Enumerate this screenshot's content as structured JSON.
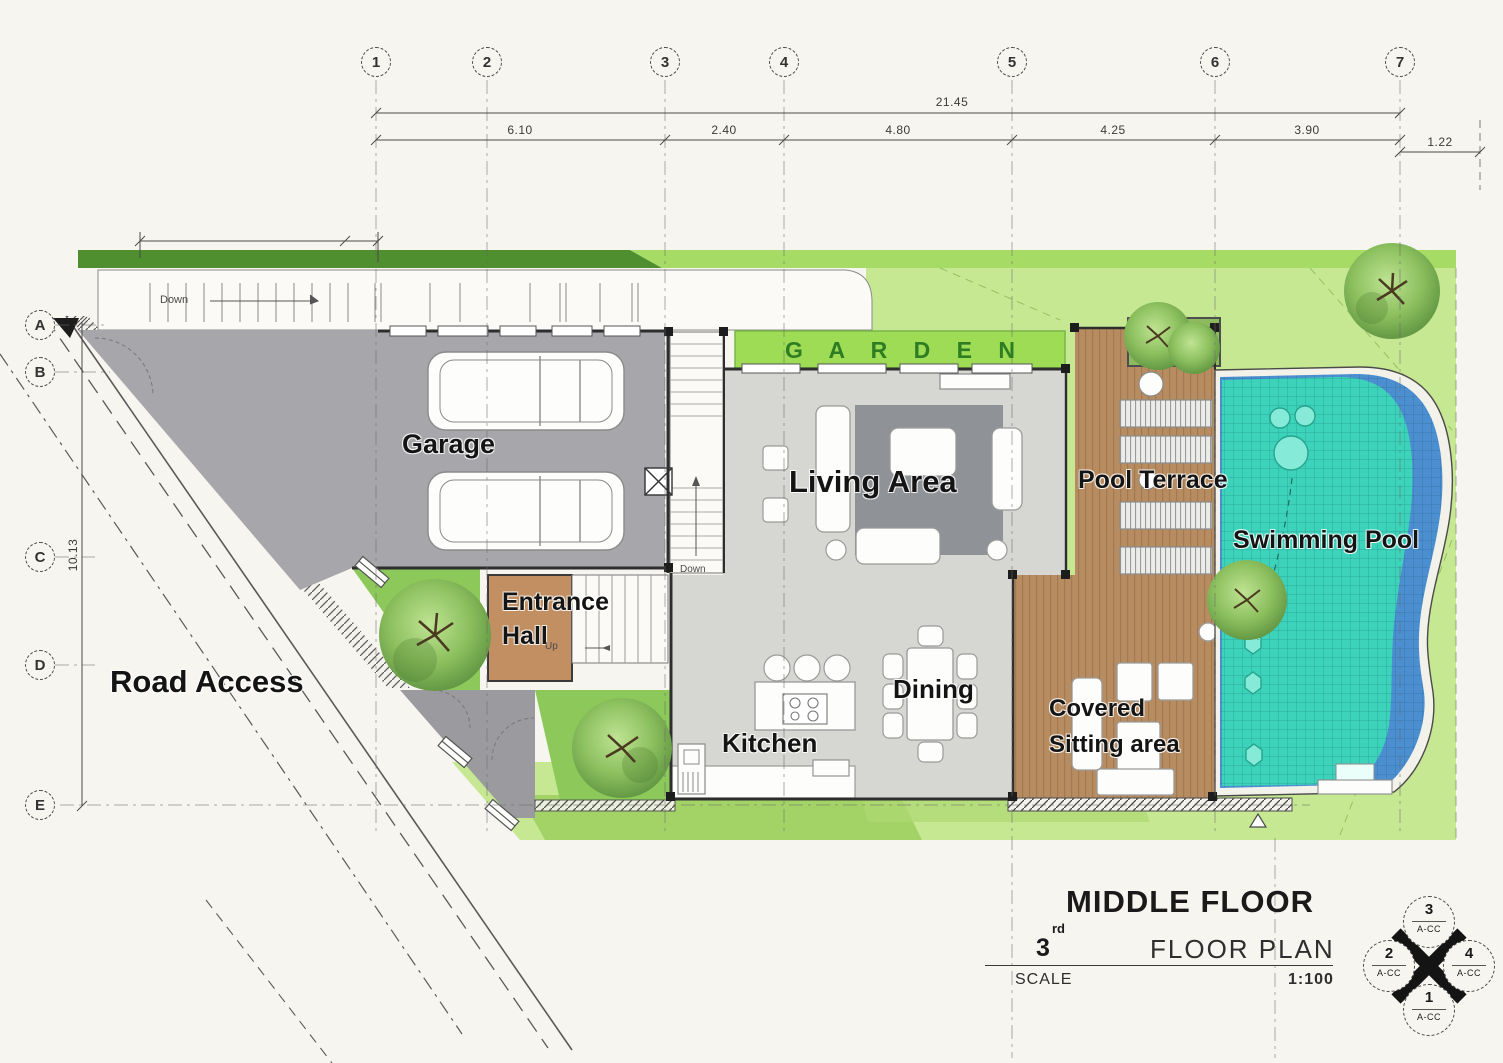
{
  "title_block": {
    "floor_title": "MIDDLE FLOOR",
    "floor_number": "3",
    "floor_ordinal": "rd",
    "plan_type": "FLOOR PLAN",
    "scale_label": "SCALE",
    "scale_value": "1:100"
  },
  "grid": {
    "columns": [
      "1",
      "2",
      "3",
      "4",
      "5",
      "6",
      "7"
    ],
    "rows": [
      "A",
      "B",
      "C",
      "D",
      "E"
    ]
  },
  "dimensions": {
    "overall_width": "21.45",
    "segments": [
      "6.10",
      "2.40",
      "4.80",
      "4.25",
      "3.90"
    ],
    "right_offset": "1.22",
    "site_depth": "10.13"
  },
  "rooms": {
    "garage": "Garage",
    "entrance_hall_line1": "Entrance",
    "entrance_hall_line2": "Hall",
    "living_area": "Living Area",
    "kitchen": "Kitchen",
    "dining": "Dining",
    "garden": "G A R D E N",
    "pool_terrace": "Pool Terrace",
    "swimming_pool": "Swimming Pool",
    "covered_sitting_line1": "Covered",
    "covered_sitting_line2": "Sitting area",
    "road_access": "Road Access"
  },
  "annotations": {
    "ramp_down": "Down",
    "stair_down": "Down",
    "stair_up": "Up"
  },
  "compass": {
    "top_number": "3",
    "right_number": "4",
    "bottom_number": "1",
    "left_number": "2",
    "sheet_ref": "A-CC"
  },
  "colors": {
    "background": "#f7f5ef",
    "driveway_gray": "#a7a7ab",
    "interior_gray": "#d6d6d2",
    "rug_gray": "#8f9296",
    "entrance_brown": "#c28f63",
    "deck_wood": "#b78c60",
    "pool_teal": "#3dd3ba",
    "pool_blue": "#4b8fd1",
    "lawn_green": "#c7e892",
    "garden_strip_green": "#9edc55",
    "hedge_green": "#4f8f2f",
    "garden_text_green": "#2e7d22"
  }
}
